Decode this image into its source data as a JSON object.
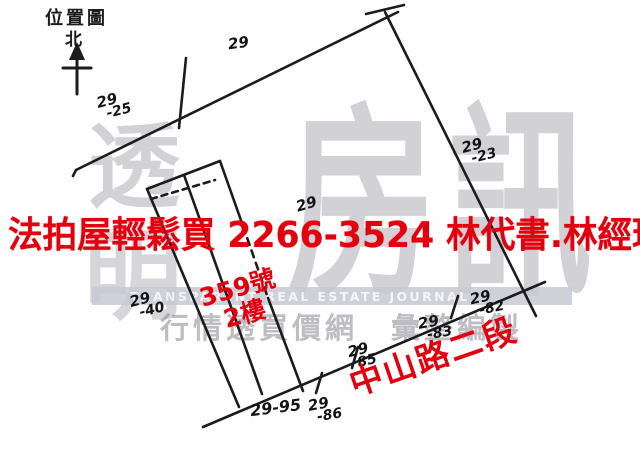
{
  "header": {
    "map_label": "位置圖",
    "north_label": "北"
  },
  "red_overlay": {
    "banner_text": "法拍屋輕鬆買 2266-3524 林代書.林經理",
    "building_number": "359號",
    "building_floor": "2樓",
    "road_name": "中山路二段",
    "red_color": "#e3000e"
  },
  "watermark": {
    "logo_char_1": "透",
    "logo_char_2": "明",
    "logo_char_3": "房",
    "logo_char_4": "訊",
    "journal_name_en": "TRANSPARENT REAL ESTATE JOURNAL",
    "journal_tagline_zh": "行情透買價網　彙整編製",
    "gray_color": "#8a8a96"
  },
  "lot_numbers": [
    {
      "line1": "29",
      "line2": ""
    },
    {
      "line1": "29",
      "line2": "-25"
    },
    {
      "line1": "29",
      "line2": "-23"
    },
    {
      "line1": "29",
      "line2": "-40"
    },
    {
      "line1": "29",
      "line2": ""
    },
    {
      "line1": "29-95",
      "line2": ""
    },
    {
      "line1": "29",
      "line2": "-86"
    },
    {
      "line1": "29",
      "line2": "85"
    },
    {
      "line1": "29",
      "line2": "-83"
    },
    {
      "line1": "29",
      "line2": "-82"
    }
  ]
}
